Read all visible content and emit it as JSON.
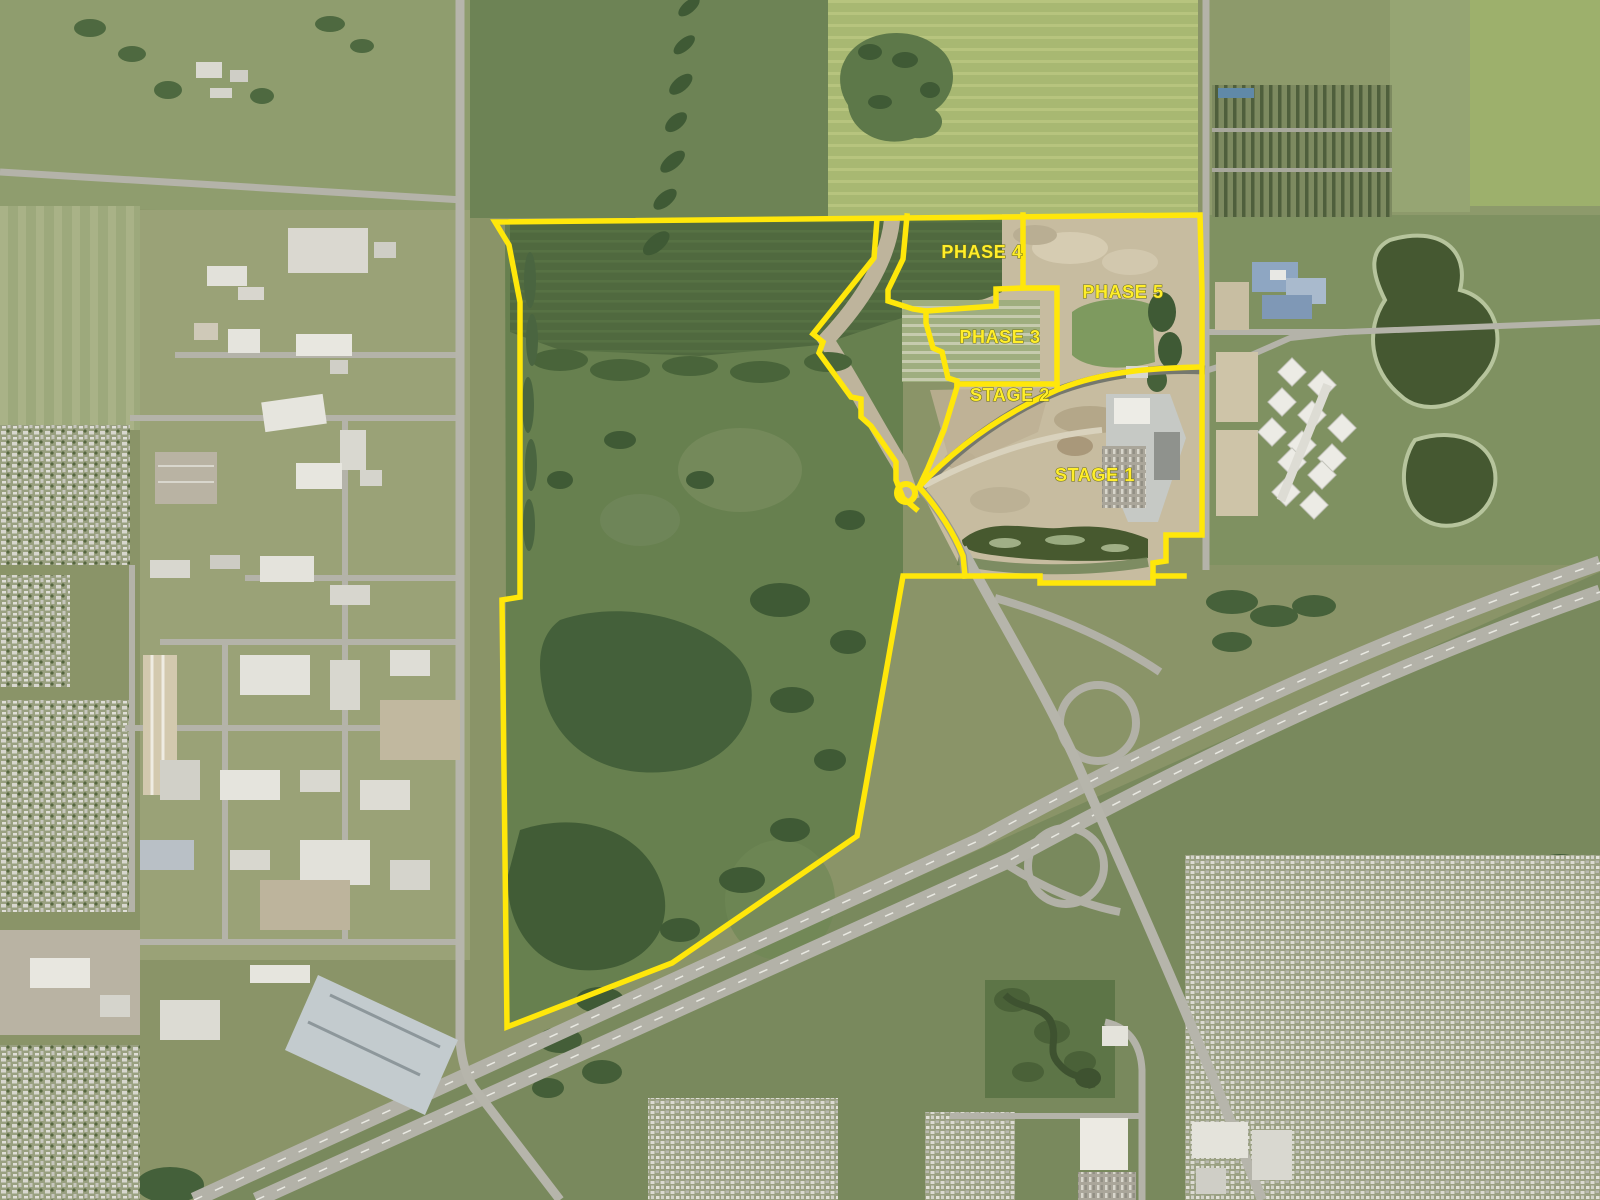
{
  "map": {
    "type": "aerial-development-staging-plan",
    "overlay": {
      "boundary_color": "#ffe70a",
      "label_color": "#ffee2b",
      "labels": [
        {
          "id": "phase-4",
          "text": "PHASE 4"
        },
        {
          "id": "phase-5",
          "text": "PHASE 5"
        },
        {
          "id": "phase-3",
          "text": "PHASE 3"
        },
        {
          "id": "stage-2",
          "text": "STAGE 2"
        },
        {
          "id": "stage-1",
          "text": "STAGE 1"
        }
      ]
    },
    "terrain_colors": {
      "field_base": "#8a9468",
      "dark_cropland": "#50693f",
      "bright_field": "#a8b872",
      "forest": "#3f5a35",
      "construction_dirt": "#c7bca0",
      "road": "#b4b3a9",
      "wetland": "#42552f",
      "building_white": "#e8e7e0"
    }
  }
}
